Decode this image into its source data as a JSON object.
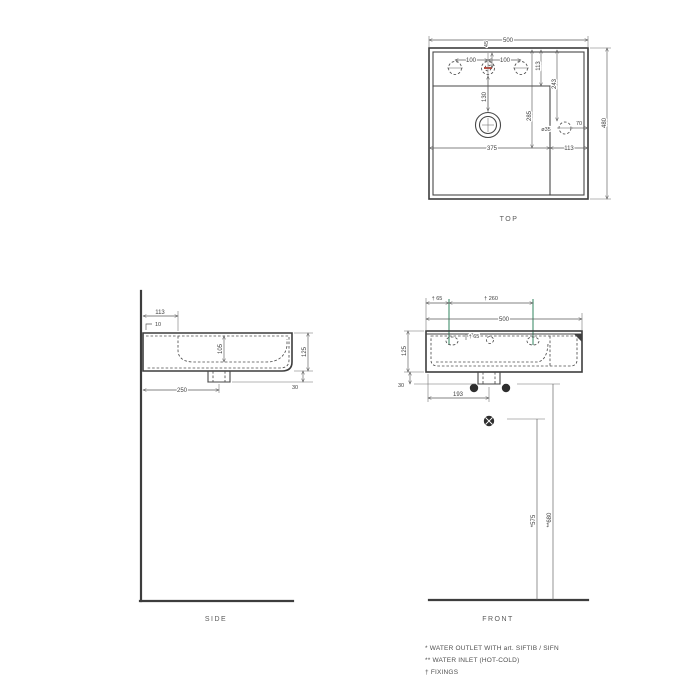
{
  "drawing": {
    "colors": {
      "line": "#474747",
      "fixing_accent": "#7fb39b",
      "hole_accent_red": "#b23b2e",
      "background": "#ffffff"
    },
    "top_view": {
      "label": "TOP",
      "width": "500",
      "depth": "480",
      "hole_left_spacing": "100",
      "hole_right_spacing": "100",
      "hole_setback": "45",
      "deck_depth": "113",
      "basin_depth": "285",
      "right_hole_from_back": "243",
      "right_hole_dia": "ø35",
      "right_hole_from_edge": "70",
      "drain_from_deck": "130",
      "bottom_left": "375",
      "bottom_right": "113"
    },
    "side_view": {
      "label": "SIDE",
      "deck_depth": "113",
      "wall_gap": "10",
      "inner_depth": "105",
      "height": "125",
      "drain_stub": "30",
      "drain_from_wall": "250"
    },
    "front_view": {
      "label": "FRONT",
      "fixing_from_edge": "† 65",
      "fixing_spacing": "† 260",
      "width": "500",
      "height": "125",
      "fixing_depth": "† 65",
      "drain_stub": "30",
      "drain_from_left": "193",
      "outlet_height": "*575",
      "inlet_height": "**680"
    },
    "legend": {
      "water_outlet": "*  WATER OUTLET WITH art. SIFTIB / SIFN",
      "water_inlet": "** WATER INLET (HOT-COLD)",
      "fixings": "† FIXINGS"
    }
  }
}
